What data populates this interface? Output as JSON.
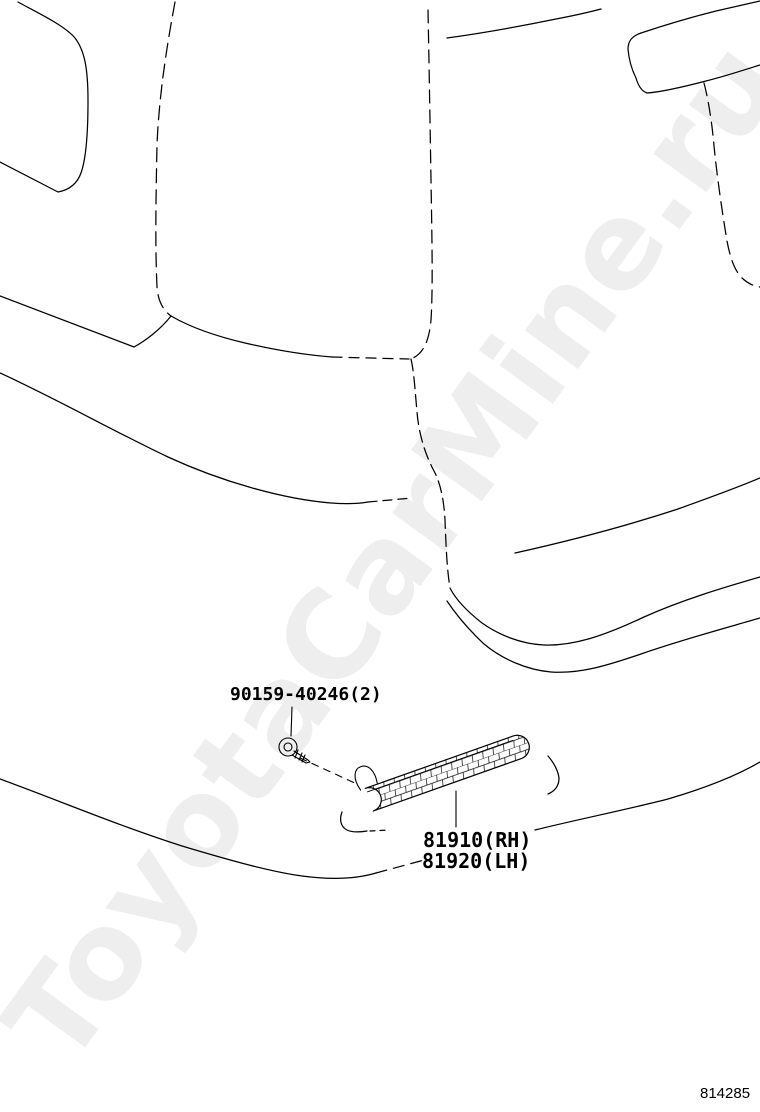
{
  "watermark": {
    "text": "ToyotaCarMine.ru"
  },
  "callouts": {
    "screw_part_number": "90159-40246(2)",
    "reflector_rh": "81910(RH)",
    "reflector_lh": "81920(LH)"
  },
  "footer": {
    "diagram_number": "814285"
  },
  "colors": {
    "line": "#000000",
    "watermark": "#eeeeee",
    "background": "#ffffff"
  }
}
